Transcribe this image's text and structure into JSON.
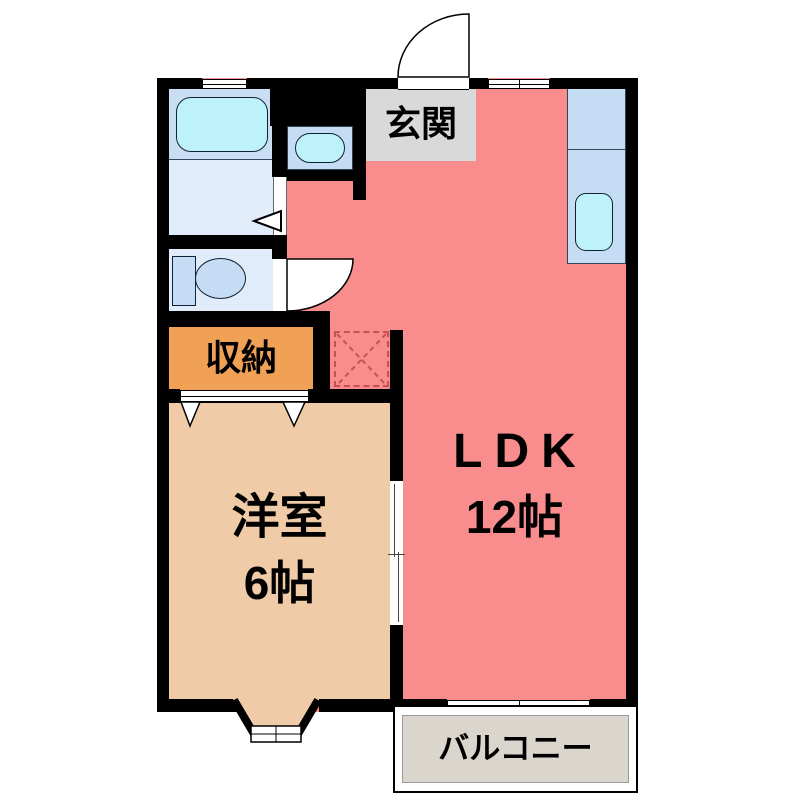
{
  "floorplan": {
    "type": "apartment-floor-plan",
    "rooms": {
      "entrance": {
        "label": "玄関"
      },
      "ldk": {
        "label": "LDK",
        "size": "12帖"
      },
      "western_room": {
        "label": "洋室",
        "size": "6帖"
      },
      "storage": {
        "label": "収納"
      },
      "balcony": {
        "label": "バルコニー"
      }
    },
    "fixtures": {
      "bathtub": "bathtub",
      "washbasin": "washbasin",
      "toilet": "toilet",
      "kitchen_sink": "kitchen-sink",
      "refrigerator_space": "refrigerator-space-dashed"
    },
    "colors": {
      "wall": "#000000",
      "ldk_fill": "#F98C8C",
      "western_room_fill": "#F0CBA7",
      "storage_fill": "#F0A155",
      "bathroom_fill": "#C9DEF4",
      "washroom_fill": "#E1ECFA",
      "counter_fill": "#C5DCF5",
      "fixture_cyan": "#BDF2FA",
      "entrance_fill": "#D9D9D9",
      "balcony_fill": "#DAD6CE",
      "refrigerator_dash": "#C85050"
    }
  }
}
